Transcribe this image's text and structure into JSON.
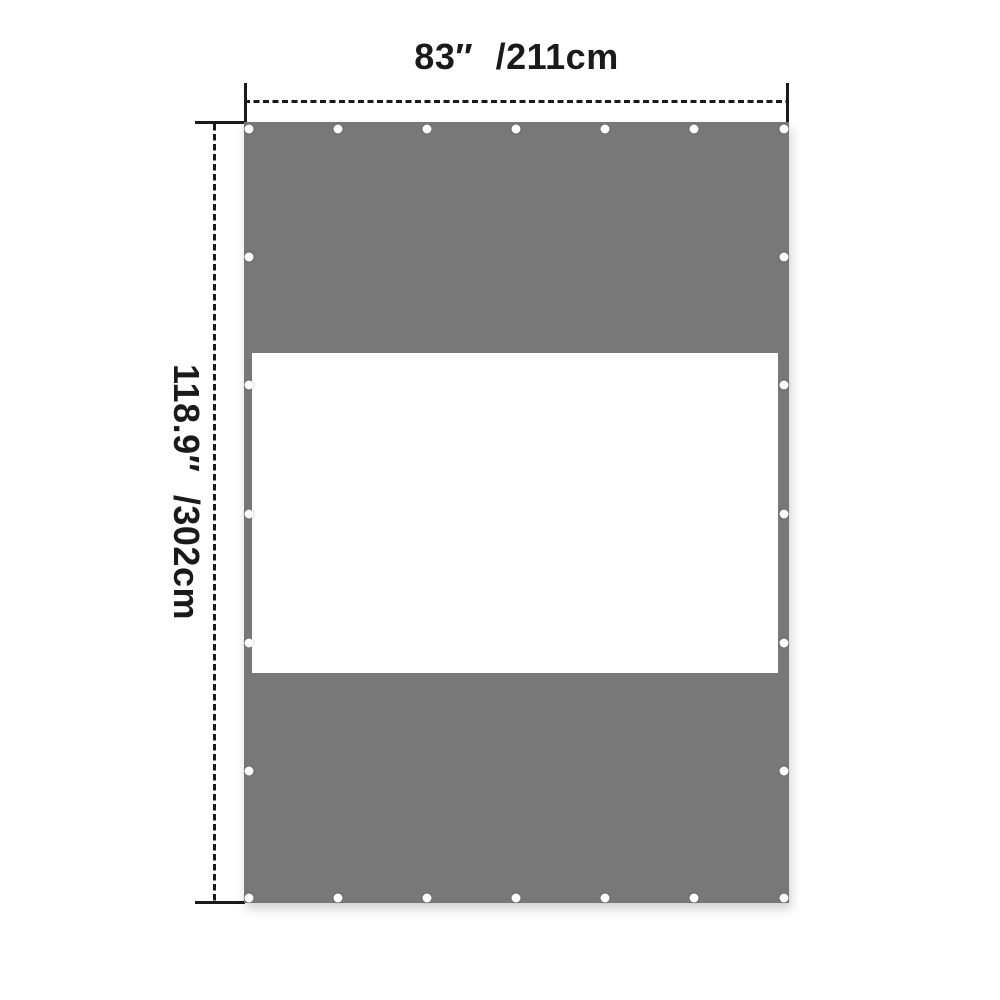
{
  "page": {
    "background_color": "#ffffff"
  },
  "diagram": {
    "name": "tarp-panel-with-window-dimension-diagram",
    "width_label": "83″ /211cm",
    "height_label": "118.9″ /302cm",
    "colors": {
      "tarp": "#787878",
      "window": "#ffffff",
      "dimension_line": "#1a1a1a",
      "grommet": "#ffffff"
    },
    "grommets": {
      "row_x_pcts": [
        0.9,
        17.2,
        33.6,
        49.9,
        66.2,
        82.6,
        99.0
      ],
      "col_y_pcts": [
        0.9,
        17.3,
        33.7,
        50.2,
        66.7,
        83.1,
        99.3
      ]
    }
  }
}
